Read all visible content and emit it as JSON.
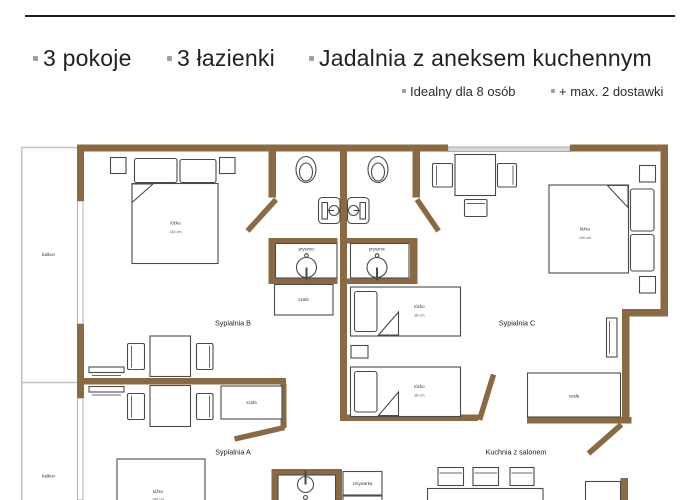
{
  "header": {
    "features": [
      {
        "label": "3 pokoje"
      },
      {
        "label": "3 łazienki"
      },
      {
        "label": "Jadalnia z aneksem kuchennym"
      }
    ],
    "details": [
      {
        "label": "Idealny dla 8 osób"
      },
      {
        "label": "+ max. 2 dostawki"
      }
    ]
  },
  "floorplan": {
    "rooms": {
      "sypialnia_a": "Sypialnia A",
      "sypialnia_b": "Sypialnia B",
      "sypialnia_c": "Sypialnia C",
      "kuchnia": "Kuchnia z salonem"
    },
    "features": {
      "balkon": "balkon",
      "szafa": "szafa",
      "prysznic": "prysznic",
      "zmywarka": "zmywarka"
    },
    "beds": {
      "double": {
        "label": "łóżko",
        "size": "140 cm"
      },
      "single": {
        "label": "łóżko",
        "size": "80 cm"
      }
    }
  },
  "colors": {
    "wall": "#8a6a45",
    "accent_text": "#1e1e1e",
    "bullet": "#9aa1a5",
    "furniture_stroke": "#4a4a4a",
    "window": "#d9d9d9",
    "balcony_stroke": "#c0c3c5"
  }
}
